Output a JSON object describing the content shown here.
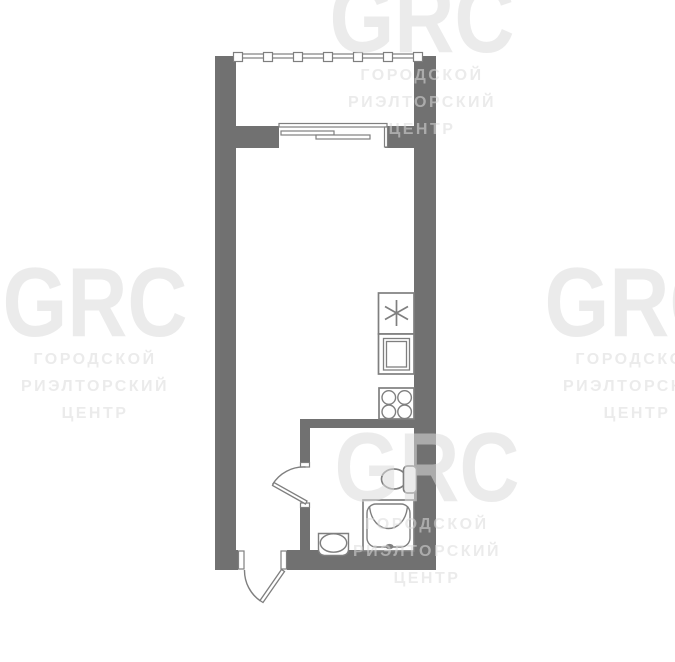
{
  "watermark": {
    "brand": "GRC",
    "line1": "ГОРОДСКОЙ",
    "line2": "РИЭЛТОРСКИЙ",
    "line3": "ЦЕНТР"
  },
  "colors": {
    "background": "#ffffff",
    "wall": "#717171",
    "fixture_line": "#7f7f7f",
    "watermark_text": "#dcdcdc"
  },
  "plan": {
    "kind": "studio-apartment-floor-plan",
    "fixtures": [
      {
        "name": "balcony-railing"
      },
      {
        "name": "balcony-sliding-window"
      },
      {
        "name": "kitchen-unit-asterisk"
      },
      {
        "name": "kitchen-sink"
      },
      {
        "name": "stove-four-burner"
      },
      {
        "name": "toilet"
      },
      {
        "name": "shower-tray"
      },
      {
        "name": "washbasin"
      },
      {
        "name": "bathroom-door-swing"
      },
      {
        "name": "entry-door-swing"
      }
    ]
  }
}
